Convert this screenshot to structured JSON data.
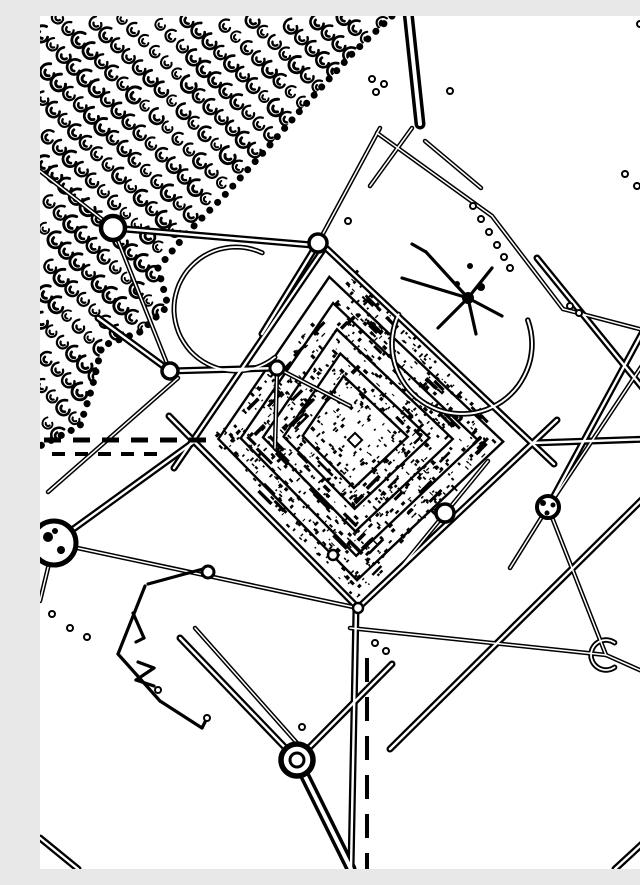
{
  "canvas": {
    "width": 640,
    "height": 853,
    "background": "#ffffff",
    "ink": "#000000",
    "seed": 7
  },
  "styles": {
    "d": {
      "w": 7,
      "core": 2.4
    },
    "t": {
      "w": 4.5,
      "core": 1.5
    },
    "T": {
      "w": 11,
      "core": 4
    },
    "s": {
      "w": 3.2,
      "core": 0
    }
  },
  "lines": [
    [
      0,
      155,
      73,
      212,
      "t"
    ],
    [
      73,
      212,
      272,
      229,
      "d"
    ],
    [
      278,
      227,
      340,
      112,
      "t"
    ],
    [
      368,
      -4,
      380,
      108,
      "T"
    ],
    [
      337,
      117,
      452,
      200,
      "t"
    ],
    [
      452,
      200,
      523,
      293,
      "t"
    ],
    [
      385,
      125,
      441,
      172,
      "t"
    ],
    [
      372,
      112,
      330,
      170,
      "t"
    ],
    [
      523,
      293,
      607,
      315,
      "t"
    ],
    [
      497,
      242,
      640,
      418,
      "d"
    ],
    [
      640,
      247,
      508,
      491,
      "d"
    ],
    [
      623,
      318,
      508,
      491,
      "t"
    ],
    [
      508,
      491,
      470,
      552,
      "t"
    ],
    [
      508,
      491,
      566,
      639,
      "t"
    ],
    [
      566,
      639,
      640,
      672,
      "t"
    ],
    [
      310,
      612,
      566,
      639,
      "t"
    ],
    [
      638,
      448,
      350,
      733,
      "d"
    ],
    [
      575,
      853,
      640,
      793,
      "d"
    ],
    [
      0,
      822,
      38,
      853,
      "d"
    ],
    [
      492,
      427,
      640,
      422,
      "d"
    ],
    [
      58,
      302,
      130,
      355,
      "d"
    ],
    [
      130,
      355,
      237,
      352,
      "d"
    ],
    [
      237,
      352,
      310,
      390,
      "t"
    ],
    [
      237,
      352,
      235,
      432,
      "t"
    ],
    [
      138,
      362,
      8,
      476,
      "t"
    ],
    [
      73,
      212,
      130,
      355,
      "t"
    ],
    [
      14,
      527,
      318,
      592,
      "t"
    ],
    [
      14,
      527,
      155,
      425,
      "d"
    ],
    [
      14,
      527,
      0,
      585,
      "t"
    ],
    [
      257,
      744,
      140,
      622,
      "d"
    ],
    [
      265,
      736,
      155,
      612,
      "t"
    ],
    [
      257,
      744,
      352,
      648,
      "d"
    ],
    [
      257,
      744,
      311,
      853,
      "T"
    ],
    [
      316,
      592,
      311,
      853,
      "d"
    ],
    [
      278,
      227,
      222,
      318,
      "d"
    ],
    [
      285,
      231,
      514,
      448,
      "d"
    ],
    [
      517,
      404,
      318,
      592,
      "d"
    ],
    [
      318,
      592,
      129,
      400,
      "d"
    ],
    [
      134,
      452,
      285,
      231,
      "d"
    ],
    [
      448,
      445,
      362,
      550,
      "t"
    ]
  ],
  "arcs": [
    {
      "cx": 196,
      "cy": 293,
      "r": 62,
      "a0": -65,
      "a1": -309,
      "w": 5,
      "core": 1.8
    },
    {
      "cx": 422,
      "cy": 328,
      "r": 70,
      "a0": 205,
      "a1": -20,
      "w": 5.5,
      "core": 2
    },
    {
      "cx": 566,
      "cy": 639,
      "r": 15,
      "a0": 55,
      "a1": 305,
      "w": 5.5,
      "core": 1.8
    }
  ],
  "diamond": {
    "center": [
      312,
      418
    ],
    "corners": [
      [
        285,
        231
      ],
      [
        492,
        427
      ],
      [
        318,
        592
      ],
      [
        153,
        424
      ]
    ],
    "inner_scales": [
      0.84,
      0.7,
      0.56,
      0.43,
      0.31
    ],
    "inner_stroke": 2.4,
    "center_square": {
      "x": 315,
      "y": 424,
      "size": 10,
      "stroke": 2
    }
  },
  "noise": {
    "cx": 315,
    "cy": 420,
    "half_w": 145,
    "half_h": 165,
    "count": 950,
    "core_frac": 0.16,
    "streaks": 70
  },
  "texture": {
    "polygon": [
      [
        0,
        0
      ],
      [
        352,
        0
      ],
      [
        312,
        38
      ],
      [
        266,
        88
      ],
      [
        222,
        138
      ],
      [
        182,
        182
      ],
      [
        148,
        216
      ],
      [
        118,
        252
      ],
      [
        128,
        290
      ],
      [
        100,
        316
      ],
      [
        62,
        330
      ],
      [
        52,
        372
      ],
      [
        40,
        410
      ],
      [
        0,
        430
      ]
    ],
    "glyph_path": "M4,-5 C-2,-7 -7,-2 -5,3 C-3,8 4,8 5,3 M-1,-1 C-3,1 -2,4 1,4",
    "glyph_stroke": 2.2,
    "chain_step": [
      11,
      11
    ],
    "row_step": [
      16,
      -16
    ],
    "origin": [
      6,
      -10
    ],
    "i_range": [
      -30,
      30
    ],
    "j_range": [
      -6,
      58
    ],
    "scallop_width": 7,
    "scallop_dash": "0.1 11"
  },
  "nodes": [
    {
      "x": 73,
      "y": 212,
      "r": 12,
      "sw": 4.5
    },
    {
      "x": 278,
      "y": 227,
      "r": 9,
      "sw": 3.5
    },
    {
      "x": 130,
      "y": 355,
      "r": 8,
      "sw": 3.5
    },
    {
      "x": 237,
      "y": 352,
      "r": 7,
      "sw": 3
    },
    {
      "x": 168,
      "y": 556,
      "r": 6,
      "sw": 3
    },
    {
      "x": 405,
      "y": 497,
      "r": 9,
      "sw": 3.5
    },
    {
      "x": 293,
      "y": 539,
      "r": 5,
      "sw": 2.5
    },
    {
      "x": 318,
      "y": 592,
      "r": 5,
      "sw": 2.5
    },
    {
      "x": 618,
      "y": 6,
      "r": 7,
      "sw": 3
    },
    {
      "x": 508,
      "y": 491,
      "r": 11,
      "sw": 4,
      "blobs": [
        [
          503,
          487,
          3
        ],
        [
          513,
          489,
          2.5
        ],
        [
          507,
          497,
          2.5
        ]
      ]
    },
    {
      "x": 623,
      "y": 318,
      "r": 17,
      "sw": 5,
      "blobs": [
        [
          616,
          311,
          4
        ],
        [
          629,
          312,
          4
        ],
        [
          617,
          326,
          4
        ],
        [
          630,
          325,
          3.5
        ]
      ]
    },
    {
      "x": 14,
      "y": 527,
      "r": 22,
      "sw": 5,
      "blobs": [
        [
          8,
          521,
          5
        ],
        [
          21,
          534,
          4
        ],
        [
          15,
          515,
          3
        ]
      ]
    },
    {
      "x": 257,
      "y": 744,
      "r": 16,
      "sw": 5.5,
      "inner": 7
    }
  ],
  "dashes": [
    {
      "x1": 4,
      "y1": 424,
      "x2": 170,
      "y2": 424,
      "dash": [
        17,
        12
      ],
      "w": 5
    },
    {
      "x1": 12,
      "y1": 438,
      "x2": 124,
      "y2": 438,
      "dash": [
        13,
        10
      ],
      "w": 4
    },
    {
      "x1": 327,
      "y1": 642,
      "x2": 327,
      "y2": 853,
      "dash": [
        24,
        15
      ],
      "w": 4
    }
  ],
  "dots": {
    "r": 3,
    "points": [
      [
        433,
        190
      ],
      [
        441,
        203
      ],
      [
        449,
        216
      ],
      [
        457,
        229
      ],
      [
        464,
        241
      ],
      [
        470,
        252
      ],
      [
        530,
        290
      ],
      [
        539,
        297
      ],
      [
        585,
        158
      ],
      [
        597,
        170
      ],
      [
        12,
        598
      ],
      [
        30,
        612
      ],
      [
        47,
        621
      ],
      [
        335,
        627
      ],
      [
        346,
        635
      ],
      [
        262,
        711
      ],
      [
        118,
        674
      ],
      [
        167,
        702
      ],
      [
        332,
        63
      ],
      [
        344,
        68
      ],
      [
        336,
        76
      ],
      [
        308,
        205
      ],
      [
        600,
        8
      ],
      [
        410,
        75
      ]
    ]
  },
  "debris": [
    [
      105,
      570,
      78,
      638
    ],
    [
      78,
      638,
      120,
      685
    ],
    [
      120,
      685,
      162,
      712
    ],
    [
      162,
      712,
      168,
      700
    ],
    [
      98,
      646,
      114,
      652
    ],
    [
      114,
      652,
      96,
      664
    ],
    [
      96,
      664,
      114,
      670
    ],
    [
      93,
      597,
      104,
      622
    ],
    [
      104,
      622,
      96,
      626
    ],
    [
      108,
      568,
      163,
      553
    ]
  ],
  "spider": {
    "legs": [
      [
        428,
        282,
        386,
        236
      ],
      [
        386,
        236,
        372,
        228
      ],
      [
        428,
        282,
        362,
        262
      ],
      [
        428,
        282,
        398,
        312
      ],
      [
        428,
        282,
        436,
        318
      ],
      [
        428,
        282,
        462,
        300
      ],
      [
        428,
        282,
        452,
        252
      ]
    ],
    "leg_width": 3.2,
    "blobs": [
      [
        428,
        282,
        6
      ],
      [
        441,
        271,
        4
      ],
      [
        417,
        268,
        3
      ],
      [
        430,
        250,
        3
      ]
    ]
  }
}
